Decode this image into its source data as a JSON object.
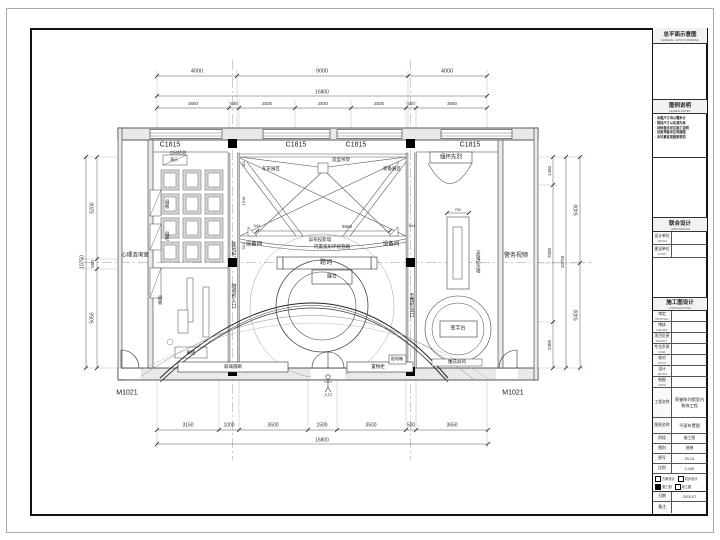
{
  "plan": {
    "window_tags": [
      "C1815",
      "C1815",
      "C1815",
      "C1815"
    ],
    "door_tags": [
      "M1021",
      "M1021"
    ],
    "labels": {
      "xl_room": "心理咨询室",
      "xr_room": "警务视频",
      "equip_l": "设备间",
      "equip_r": "设备间",
      "cab_l": "陈列柜",
      "tunnel": "隧道形入口",
      "pent": "五角形出口",
      "martyrs": "缅怀先烈",
      "herowall": "英雄纪念墙",
      "sign": "签字台",
      "screen": "雕花屏风",
      "inscription": "题词",
      "stage": "展台",
      "truss_l": "军史展区",
      "truss_c": "造型吊架",
      "truss_r": "装备展区",
      "arc1": "异形投影墙",
      "arc2": "内置弧形环绕音箱",
      "auto": "自动检测",
      "demo": "演示",
      "board1": "展板",
      "board2": "展柜",
      "board3": "展板",
      "lowcab": "展柜",
      "glass": "玻璃隔断",
      "shelf": "置物柜",
      "elec": "配电箱",
      "entry": "入口"
    },
    "dims": {
      "top1": [
        "4000",
        "9000",
        "4000"
      ],
      "top_total": "16800",
      "top2": [
        "3650",
        "500",
        "2835",
        "2830",
        "2835",
        "500",
        "3650"
      ],
      "bottom": [
        "3150",
        "1000",
        "3500",
        "1500",
        "3500",
        "500",
        "3650"
      ],
      "bottom_total": "16800",
      "left": [
        "5200",
        "500",
        "5050"
      ],
      "left_total": "10750",
      "right_inner": [
        "1450",
        "7000",
        "2300"
      ],
      "right_total": "10750",
      "right_outer": [
        "5400",
        "5400"
      ],
      "inner": {
        "c": "5566",
        "l": "544",
        "r": "544",
        "disp": "750",
        "v1": "451",
        "v2": "1618",
        "v3": "551"
      }
    }
  },
  "titleblock": {
    "header": {
      "cn": "总平面示意图",
      "en": "GENERAL LAYOUT DRAWING"
    },
    "legend": {
      "cn": "图例说明",
      "en": "LEGEND NOTES"
    },
    "notes": [
      "· 本图尺寸均以毫米计",
      "· 现场尺寸以实测为准",
      "· 材料做法详见施工说明",
      "· 设备预留详见电施图",
      "· 未尽事宜按国家规范"
    ],
    "joint": {
      "cn": "联合设计",
      "en": "JOINT DESIGN"
    },
    "units": [
      {
        "label": "设计单位",
        "en": "DESIGN"
      },
      {
        "label": "建设单位",
        "en": "CLIENT"
      }
    ],
    "stage_header": {
      "cn": "施工图设计",
      "en": "CONSTRUCTION"
    },
    "sign_rows": [
      {
        "label": "审定",
        "en": "APPROVED"
      },
      {
        "label": "审核",
        "en": "CHECKED"
      },
      {
        "label": "项目负责",
        "en": "PROJECT"
      },
      {
        "label": "专业负责",
        "en": "CHIEF"
      },
      {
        "label": "校对",
        "en": "PROOF"
      },
      {
        "label": "设计",
        "en": "DESIGN"
      },
      {
        "label": "制图",
        "en": "DRAW"
      }
    ],
    "project": {
      "label": "工程名称",
      "value": "荣誉陈列馆室内装饰工程"
    },
    "drawing": {
      "label": "图纸名称",
      "value": "平面布置图"
    },
    "meta_rows": [
      {
        "label": "阶段",
        "value": "施工图"
      },
      {
        "label": "图别",
        "value": "装施"
      },
      {
        "label": "图号",
        "value": "JS-01"
      },
      {
        "label": "比例",
        "value": "1:100"
      }
    ],
    "checks": {
      "label": "出图种类",
      "options": [
        "方案设计",
        "初步设计",
        "施工图",
        "竣工图"
      ]
    },
    "date_row": {
      "label": "日期",
      "value": "2015.07"
    },
    "note_row": {
      "label": "备注",
      "value": ""
    }
  }
}
